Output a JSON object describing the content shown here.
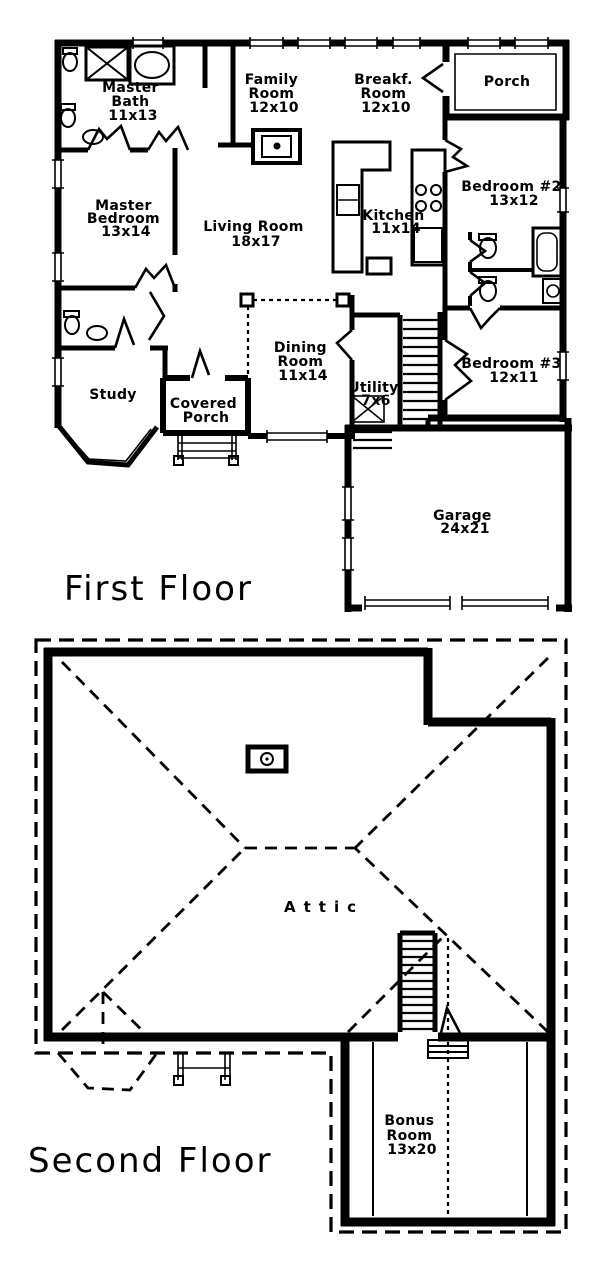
{
  "first_floor": {
    "title": "First Floor",
    "rooms": {
      "master_bath": {
        "lines": [
          "Master",
          "Bath",
          "11x13"
        ]
      },
      "family_room": {
        "lines": [
          "Family",
          "Room",
          "12x10"
        ]
      },
      "breakf_room": {
        "lines": [
          "Breakf.",
          "Room",
          "12x10"
        ]
      },
      "porch": {
        "lines": [
          "Porch"
        ]
      },
      "master_bedroom": {
        "lines": [
          "Master",
          "Bedroom",
          "13x14"
        ]
      },
      "living_room": {
        "lines": [
          "Living Room",
          "18x17"
        ]
      },
      "kitchen": {
        "lines": [
          "Kitchen",
          "11x14"
        ]
      },
      "bedroom_2": {
        "lines": [
          "Bedroom #2",
          "13x12"
        ]
      },
      "dining_room": {
        "lines": [
          "Dining",
          "Room",
          "11x14"
        ]
      },
      "utility": {
        "lines": [
          "Utility",
          "7x6"
        ]
      },
      "bedroom_3": {
        "lines": [
          "Bedroom #3",
          "12x11"
        ]
      },
      "study": {
        "lines": [
          "Study"
        ]
      },
      "covered_porch": {
        "lines": [
          "Covered",
          "Porch"
        ]
      },
      "garage": {
        "lines": [
          "Garage",
          "24x21"
        ]
      }
    }
  },
  "second_floor": {
    "title": "Second Floor",
    "rooms": {
      "attic": {
        "lines": [
          "Attic"
        ]
      },
      "bonus_room": {
        "lines": [
          "Bonus",
          "Room",
          "13x20"
        ]
      }
    }
  },
  "colors": {
    "ink": "#000000",
    "paper": "#ffffff"
  }
}
